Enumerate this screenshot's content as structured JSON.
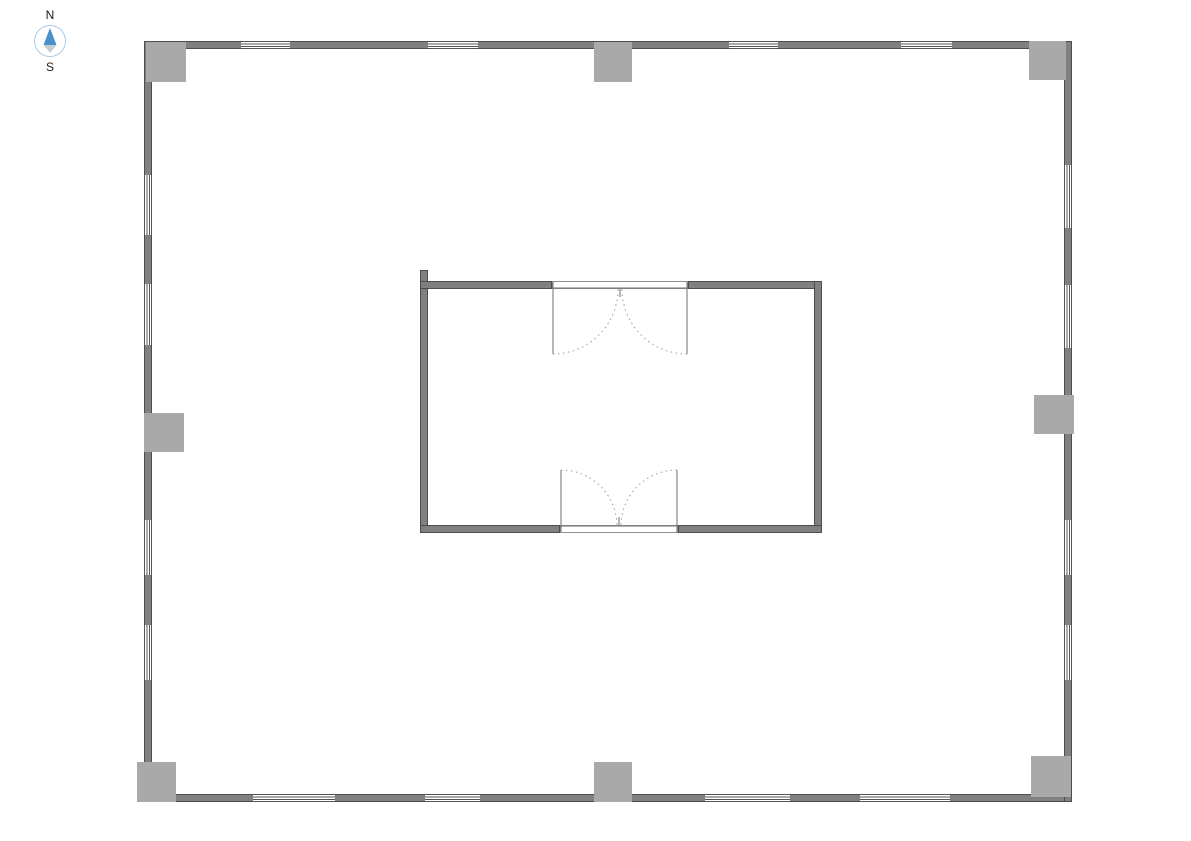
{
  "colors": {
    "background": "#ffffff",
    "wall_fill": "#808080",
    "wall_edge": "#4d4d4d",
    "column_fill": "#a9a9a9",
    "window_line": "#555555",
    "door_line": "#6f6f6f",
    "door_arc": "#9b9b9b",
    "compass_ring": "#a9cbe8",
    "compass_north": "#4a90cd",
    "compass_south": "#c8cdd1",
    "label_text": "#1a1a1a"
  },
  "compass": {
    "north_label": "N",
    "south_label": "S"
  },
  "plan": {
    "outer_walls": [
      {
        "name": "outer-wall-north",
        "x": 144,
        "y": 41,
        "w": 928,
        "h": 8
      },
      {
        "name": "outer-wall-south",
        "x": 144,
        "y": 794,
        "w": 928,
        "h": 8
      },
      {
        "name": "outer-wall-west",
        "x": 144,
        "y": 41,
        "w": 8,
        "h": 761
      },
      {
        "name": "outer-wall-east",
        "x": 1064,
        "y": 41,
        "w": 8,
        "h": 761
      }
    ],
    "inner_walls": [
      {
        "name": "core-wall-west",
        "x": 420,
        "y": 270,
        "w": 8,
        "h": 263
      },
      {
        "name": "core-wall-north-left",
        "x": 420,
        "y": 281,
        "w": 132,
        "h": 8
      },
      {
        "name": "core-wall-north-right",
        "x": 688,
        "y": 281,
        "w": 134,
        "h": 8
      },
      {
        "name": "core-wall-east",
        "x": 814,
        "y": 281,
        "w": 8,
        "h": 252
      },
      {
        "name": "core-wall-south-left",
        "x": 420,
        "y": 525,
        "w": 140,
        "h": 8
      },
      {
        "name": "core-wall-south-right",
        "x": 678,
        "y": 525,
        "w": 144,
        "h": 8
      }
    ],
    "columns": [
      {
        "name": "column-northwest",
        "x": 146,
        "y": 42,
        "w": 40,
        "h": 40
      },
      {
        "name": "column-north-mid",
        "x": 594,
        "y": 42,
        "w": 38,
        "h": 40
      },
      {
        "name": "column-northeast",
        "x": 1029,
        "y": 41,
        "w": 37,
        "h": 39
      },
      {
        "name": "column-west-mid",
        "x": 144,
        "y": 413,
        "w": 40,
        "h": 39
      },
      {
        "name": "column-east-mid",
        "x": 1034,
        "y": 395,
        "w": 40,
        "h": 39
      },
      {
        "name": "column-southwest",
        "x": 137,
        "y": 762,
        "w": 39,
        "h": 40
      },
      {
        "name": "column-south-mid",
        "x": 594,
        "y": 762,
        "w": 38,
        "h": 40
      },
      {
        "name": "column-southeast",
        "x": 1031,
        "y": 756,
        "w": 40,
        "h": 41
      }
    ],
    "windows": [
      {
        "o": "h",
        "x": 241,
        "y": 41,
        "w": 49,
        "h": 8
      },
      {
        "o": "h",
        "x": 428,
        "y": 41,
        "w": 50,
        "h": 8
      },
      {
        "o": "h",
        "x": 729,
        "y": 41,
        "w": 49,
        "h": 8
      },
      {
        "o": "h",
        "x": 901,
        "y": 41,
        "w": 51,
        "h": 8
      },
      {
        "o": "h",
        "x": 253,
        "y": 794,
        "w": 82,
        "h": 8
      },
      {
        "o": "h",
        "x": 425,
        "y": 794,
        "w": 55,
        "h": 8
      },
      {
        "o": "h",
        "x": 705,
        "y": 794,
        "w": 85,
        "h": 8
      },
      {
        "o": "h",
        "x": 860,
        "y": 794,
        "w": 90,
        "h": 8
      },
      {
        "o": "v",
        "x": 144,
        "y": 175,
        "w": 8,
        "h": 60
      },
      {
        "o": "v",
        "x": 144,
        "y": 284,
        "w": 8,
        "h": 61
      },
      {
        "o": "v",
        "x": 144,
        "y": 520,
        "w": 8,
        "h": 55
      },
      {
        "o": "v",
        "x": 144,
        "y": 625,
        "w": 8,
        "h": 55
      },
      {
        "o": "v",
        "x": 1064,
        "y": 165,
        "w": 8,
        "h": 63
      },
      {
        "o": "v",
        "x": 1064,
        "y": 285,
        "w": 8,
        "h": 63
      },
      {
        "o": "v",
        "x": 1064,
        "y": 520,
        "w": 8,
        "h": 55
      },
      {
        "o": "v",
        "x": 1064,
        "y": 625,
        "w": 8,
        "h": 55
      }
    ],
    "doors": [
      {
        "name": "double-door-north",
        "opening": {
          "x": 552,
          "y": 281,
          "w": 136,
          "h": 8
        },
        "header_line": {
          "x1": 552,
          "y1": 288,
          "x2": 688,
          "y2": 288
        },
        "center_tick": {
          "x1": 620,
          "y1": 289,
          "x2": 620,
          "y2": 297
        },
        "leaves": [
          {
            "x1": 553,
            "y1": 282,
            "x2": 553,
            "y2": 354
          },
          {
            "x1": 687,
            "y1": 282,
            "x2": 687,
            "y2": 354
          }
        ],
        "arcs": [
          "M 553 354 A 65 65 0 0 0 618 289",
          "M 687 354 A 65 65 0 0 1 622 289"
        ]
      },
      {
        "name": "double-door-south",
        "opening": {
          "x": 560,
          "y": 525,
          "w": 118,
          "h": 8
        },
        "header_line": {
          "x1": 560,
          "y1": 526,
          "x2": 678,
          "y2": 526
        },
        "center_tick": {
          "x1": 619,
          "y1": 517,
          "x2": 619,
          "y2": 525
        },
        "leaves": [
          {
            "x1": 561,
            "y1": 470,
            "x2": 561,
            "y2": 532
          },
          {
            "x1": 677,
            "y1": 470,
            "x2": 677,
            "y2": 532
          }
        ],
        "arcs": [
          "M 561 470 A 56 56 0 0 1 617 526",
          "M 677 470 A 56 56 0 0 0 621 526"
        ]
      }
    ]
  }
}
